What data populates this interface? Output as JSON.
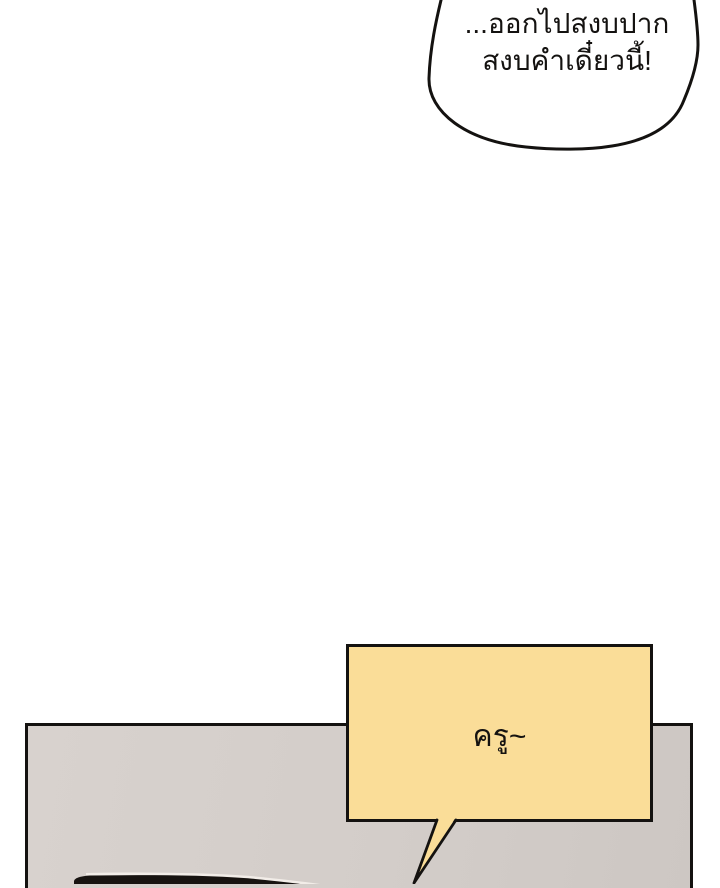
{
  "page": {
    "background": "#ffffff"
  },
  "colors": {
    "ink": "#141210",
    "bubble-yellow": "#fadd98",
    "panel-light": "#d8d2ce",
    "panel-dark": "#cdc7c3",
    "object-black": "#171310",
    "highlight-white": "#f2ede8",
    "paper": "#ffffff"
  },
  "bubbles": {
    "shout": {
      "fill": "#ffffff",
      "lines": [
        "...ออกไปสงบปาก",
        "สงบคำเดี๋ยวนี้!"
      ]
    },
    "call": {
      "fill": "#fadd98",
      "text": "ครู~"
    }
  }
}
